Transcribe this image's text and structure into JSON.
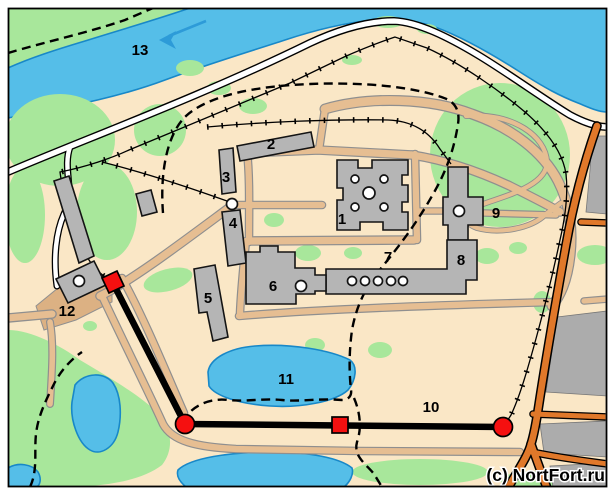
{
  "map": {
    "copyright": "(c) NortFort.ru",
    "labels": {
      "n1": "1",
      "n2": "2",
      "n3": "3",
      "n4": "4",
      "n5": "5",
      "n6": "6",
      "n7": "7",
      "n8": "8",
      "n9": "9",
      "n10": "10",
      "n11": "11",
      "n12": "12",
      "n13": "13"
    },
    "colors": {
      "water": "#55BEE8",
      "vegetation": "#A8E79B",
      "land": "#FAE7C6",
      "road": "#E6BE92",
      "highway": "#E0782A",
      "building": "#B5B5B5",
      "wall": "#000000",
      "marker": "#F51010"
    }
  }
}
